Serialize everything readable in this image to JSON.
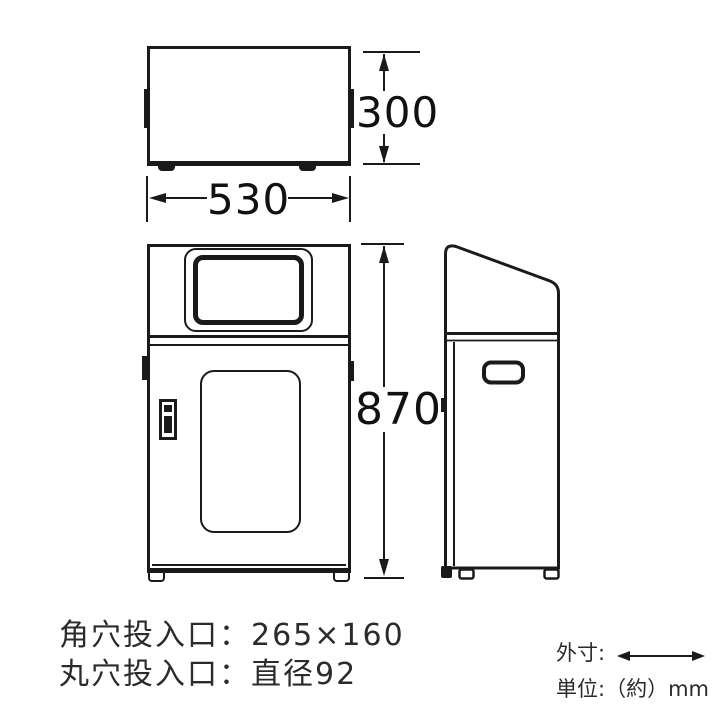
{
  "diagram": {
    "background": "#ffffff",
    "line_color": "#1a1a1a",
    "dimensions": {
      "depth": "300",
      "width": "530",
      "height": "870"
    },
    "notes": {
      "square_slot": "角穴投入口：265×160",
      "round_slot": "丸穴投入口：直径92"
    },
    "legend": {
      "outer_label": "外寸:",
      "unit_label": "単位:（約）mm"
    }
  }
}
